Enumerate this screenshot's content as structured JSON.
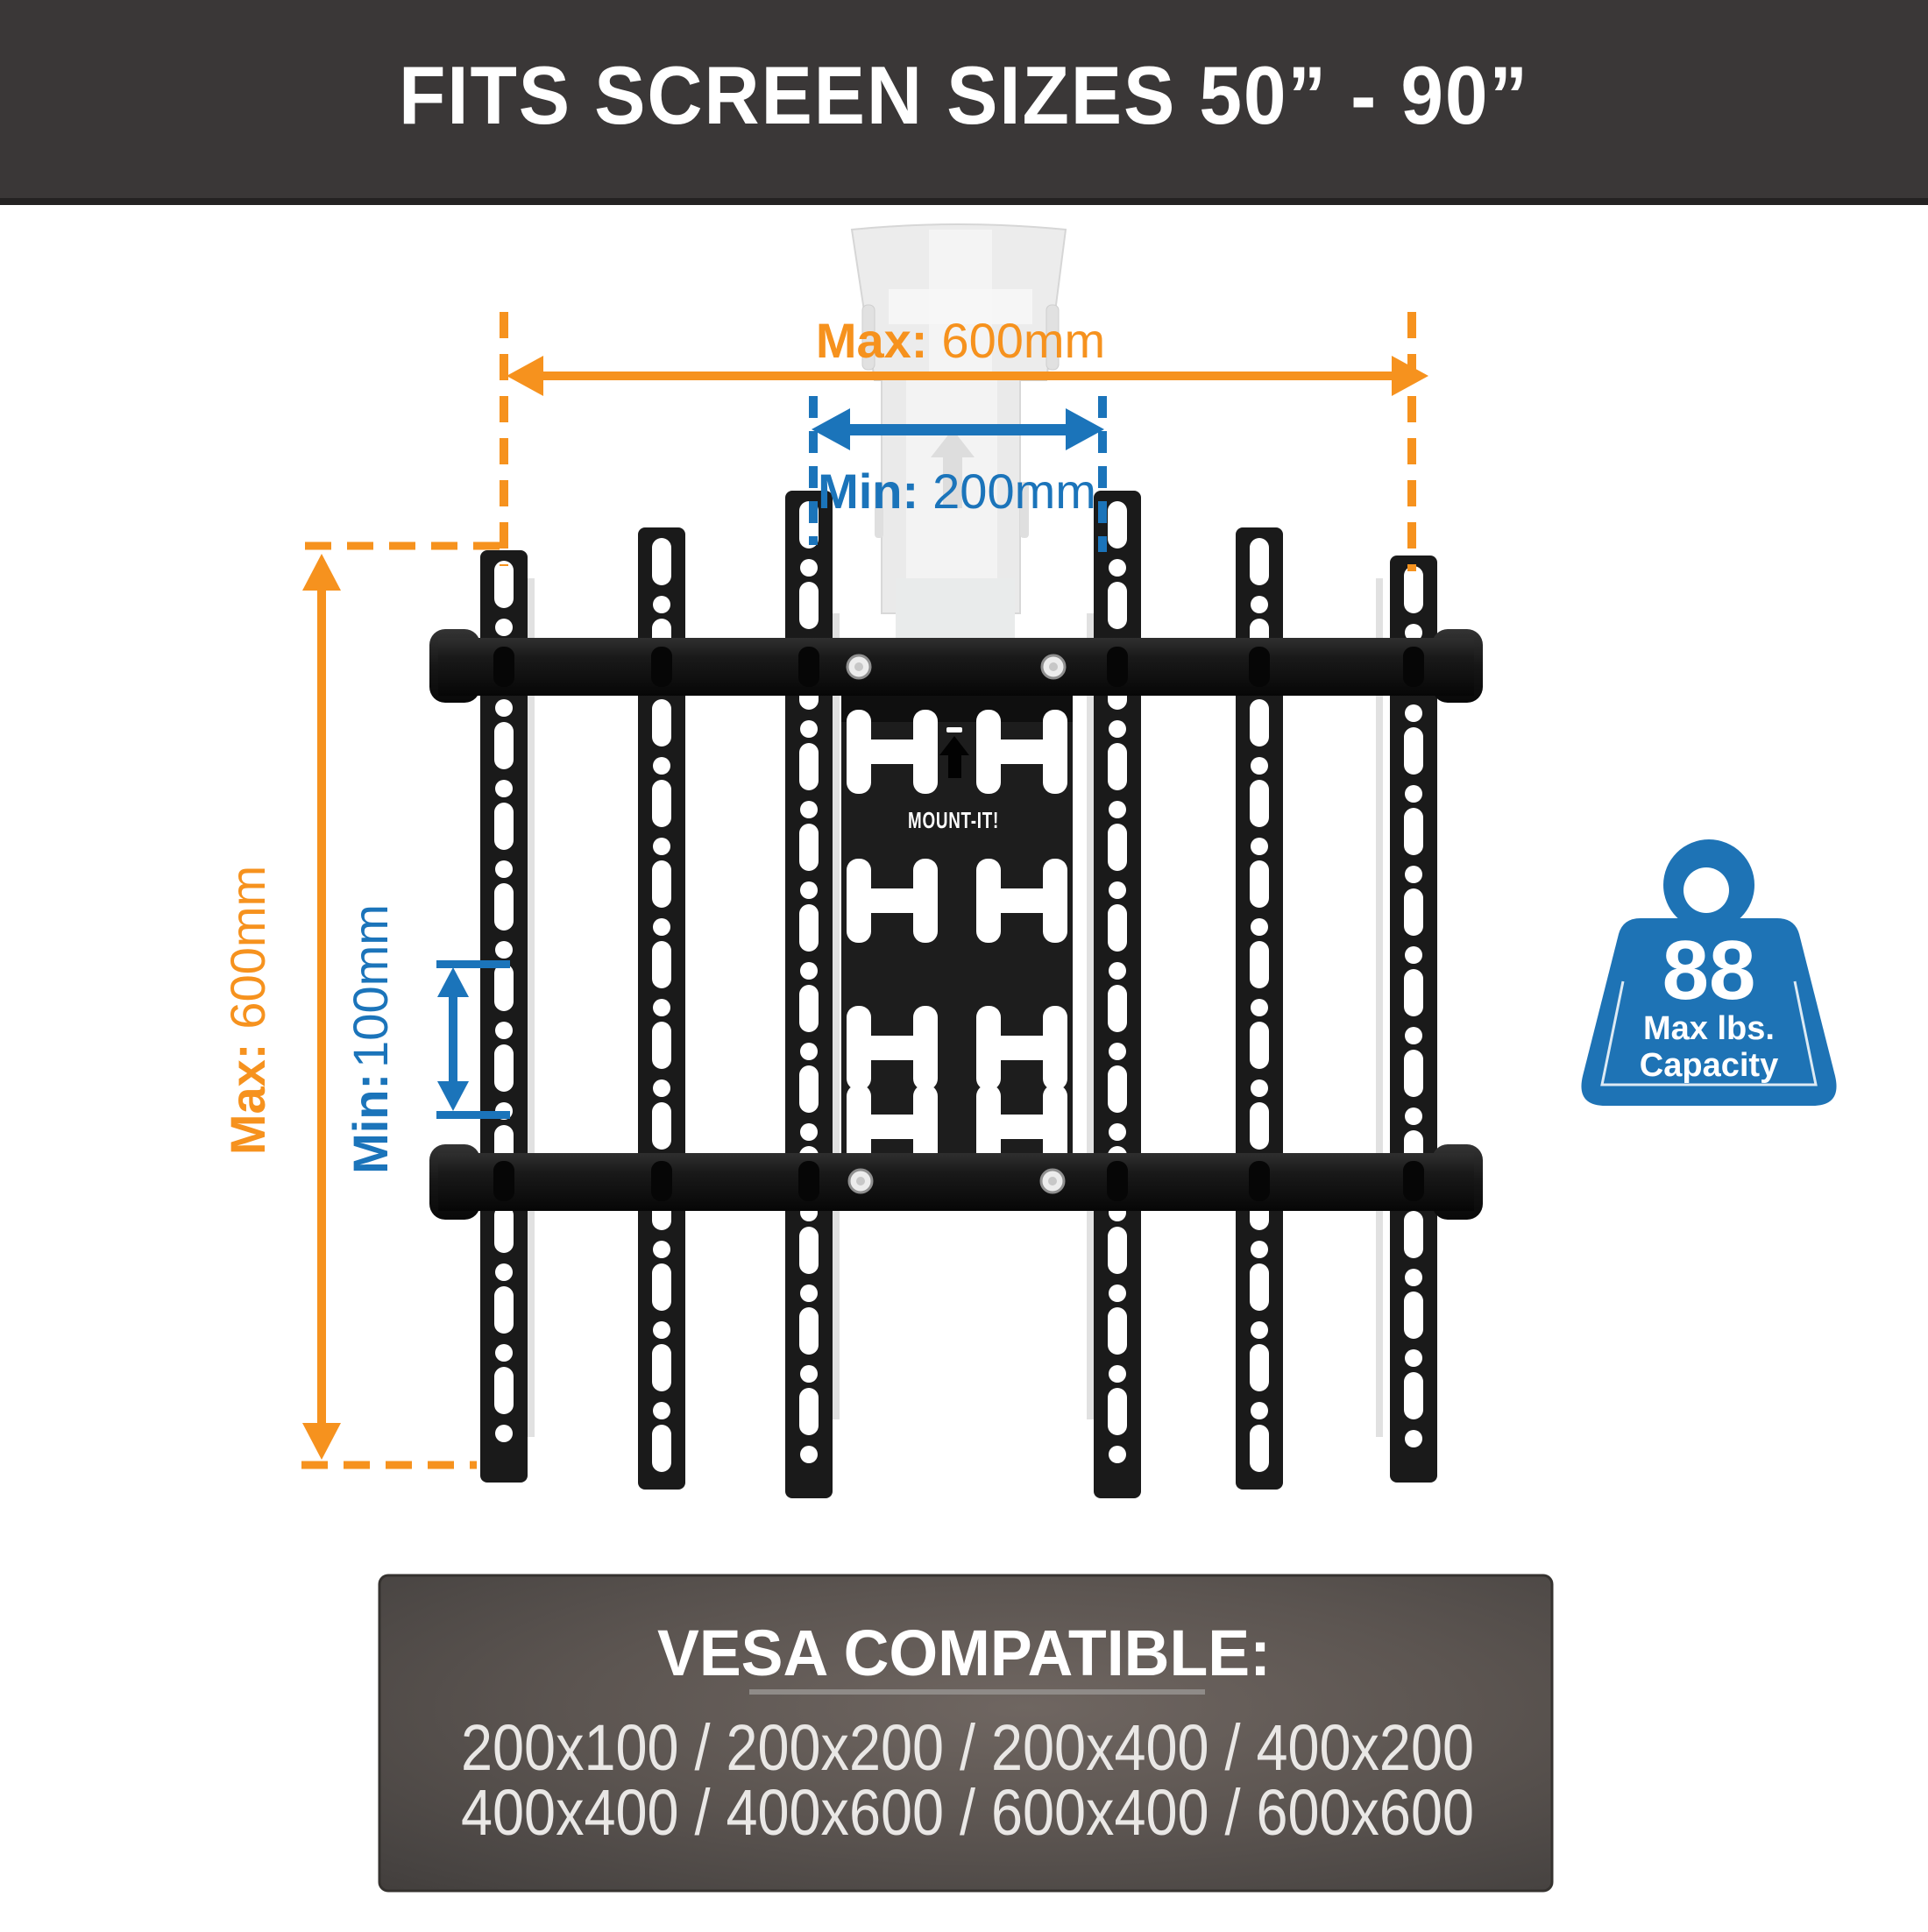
{
  "banner": {
    "title": "FITS SCREEN SIZES 50” - 90”"
  },
  "annotations": {
    "width_max": {
      "label": "Max:",
      "value": "600mm"
    },
    "width_min": {
      "label": "Min:",
      "value": "200mm"
    },
    "height_max": {
      "label": "Max:",
      "value": "600mm"
    },
    "height_min": {
      "label": "Min:",
      "value": "100mm"
    }
  },
  "plate": {
    "brand": "MOUNT-IT!"
  },
  "weight_badge": {
    "value": "88",
    "unit": "Max lbs.",
    "label": "Capacity"
  },
  "vesa_panel": {
    "heading": "VESA COMPATIBLE:",
    "row1": "200x100 / 200x200 / 200x400 / 400x200",
    "row2": "400x400 / 400x600 / 600x400 / 600x600"
  },
  "colors": {
    "orange": "#f6921e",
    "blue": "#1b74ba",
    "weight_blue": "#1e73b5",
    "banner_bg": "#3a3737"
  }
}
